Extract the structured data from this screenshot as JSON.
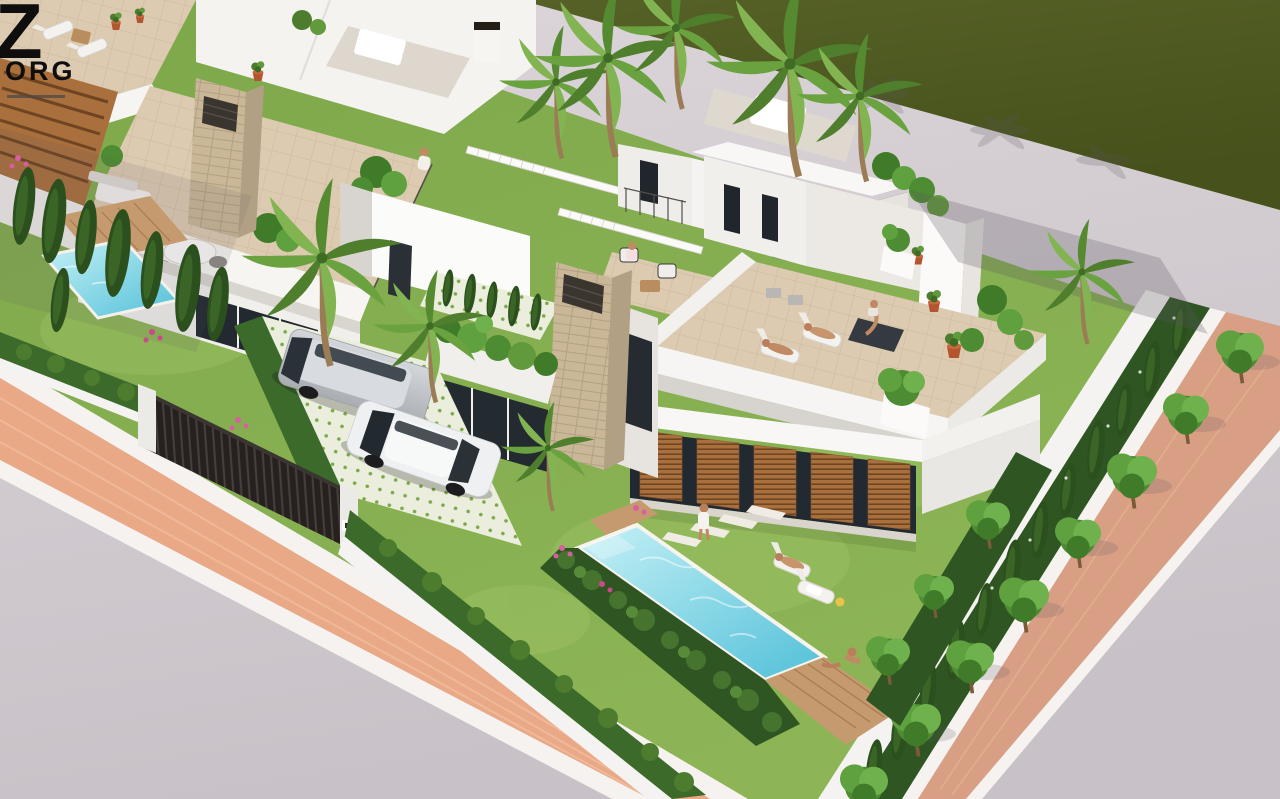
{
  "window": {
    "width": 1280,
    "height": 799
  },
  "logo": {
    "letter": "Z",
    "word": "ORG",
    "tagline_present": true
  },
  "scene": {
    "type": "3d-architectural-render",
    "view": "aerial-isometric",
    "description": "Aerial 3D render of modern white villas with roof terraces, private pools, landscaped gardens, two parked cars, palm trees and hedges, bordered by a brick-paved sidewalk street and a dark green field behind a light footpath",
    "people_visible": 10,
    "vehicles": [
      {
        "name": "silver-minivan"
      },
      {
        "name": "white-hatchback"
      }
    ],
    "features": [
      "main-villa-roof-terrace-with-sunloungers-and-yoga",
      "main-garden-rectangular-pool-with-wood-deck",
      "left-villa-roof-lounge-with-round-table",
      "left-garden-small-pool-with-cypresses",
      "stone-clad-chimney-columns",
      "wooden-louver-facade-panels",
      "white-pergola-slats-over-entry",
      "driveway-with-patterned-tiles-and-gate",
      "street-trees-row-on-brick-sidewalk",
      "dark-green-field-behind-footpath"
    ],
    "palette": {
      "golf": "#4d5820",
      "road": "#cfc8cd",
      "road_light": "#ded8dc",
      "brick": "#e9a987",
      "brick2": "#d89f84",
      "curb": "#f6f2ef",
      "grass": "#85af4e",
      "grass_light": "#9cc363",
      "hedge": "#3c6a2b",
      "hedge_dark": "#2e5522",
      "cypress": "#2c501d",
      "pool_light": "#c6f1f6",
      "pool_deep": "#52c0d8",
      "deck": "#c49a6e",
      "louver": "#a96f3c",
      "stone": "#c9b797",
      "tile": "#dccab1",
      "white": "#f6f5f2",
      "white_shade": "#e7e4e0",
      "white_dark": "#d3d0cb",
      "glass": "#222930",
      "trim": "#241e19",
      "fence": "#282320",
      "silver": "#bfc3c7",
      "car_white": "#eef0f1",
      "skin": "#c08a64",
      "flower": "#d85f9e",
      "terracotta": "#b4552f",
      "frond": "#5d9038",
      "trunk": "#9a7d55",
      "shadow": "#5c5560"
    }
  }
}
